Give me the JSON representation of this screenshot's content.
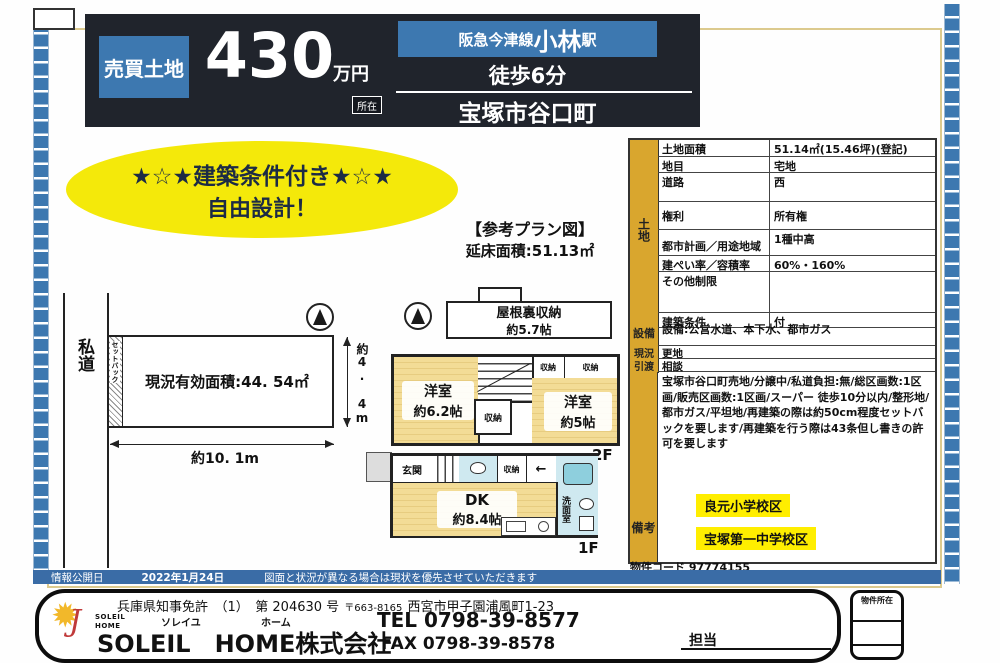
{
  "header": {
    "property_type": "売買土地",
    "price": "430",
    "price_unit": "万円",
    "rail_line": "阪急今津線 ",
    "station": "小林",
    "station_suffix": "駅",
    "walk": "徒歩6分",
    "location_tag": "所在",
    "address": "宝塚市谷口町"
  },
  "banner": {
    "line1": "★☆★建築条件付き★☆★",
    "line2": "自由設計！"
  },
  "plan": {
    "title": "【参考プラン図】",
    "total_floor_area": "延床面積:51.13㎡"
  },
  "site": {
    "road": "私道",
    "setback": "セットバック",
    "effective_area": "現況有効面積:44. 54㎡",
    "width": "約10. 1m",
    "depth": "約4. 4m"
  },
  "floor2": {
    "attic_line1": "屋根裏収納",
    "attic_line2": "約5.7帖",
    "room_left_line1": "洋室",
    "room_left_line2": "約6.2帖",
    "room_right_line1": "洋室",
    "room_right_line2": "約5帖",
    "closet": "収納",
    "label": "2F"
  },
  "floor1": {
    "entrance": "玄関",
    "closet": "収納",
    "dk_line1": "DK",
    "dk_line2": "約8.4帖",
    "washroom": "洗面室",
    "label": "1F"
  },
  "table": {
    "section_land": "土地",
    "rows": [
      {
        "label": "土地面積",
        "value": "51.14㎡(15.46坪)(登記)"
      },
      {
        "label": "地目",
        "value": "宅地"
      },
      {
        "label": "道路",
        "value": "西"
      },
      {
        "label": "権利",
        "value": "所有権"
      },
      {
        "label": "都市計画／用途地域",
        "value": "1種中高"
      },
      {
        "label": "建ぺい率／容積率",
        "value": "60%・160%"
      },
      {
        "label": "その他制限",
        "value": ""
      },
      {
        "label": "建築条件",
        "value": "付"
      }
    ],
    "section_setsubi": "設備",
    "setsubi_value": "設備:公営水道、本下水、都市ガス",
    "section_genkyo": "現況",
    "genkyo_value": "更地",
    "section_hikiwatashi": "引渡",
    "hikiwatashi_value": "相談",
    "section_biko": "備考",
    "biko_value": "宝塚市谷口町売地/分譲中/私道負担:無/総区画数:1区画/販売区画数:1区画/スーパー 徒歩10分以内/整形地/都市ガス/平坦地/再建築の際は約50cm程度セットバックを要します/再建築を行う際は43条但し書きの許可を要します",
    "school1": "良元小学校区",
    "school2": "宝塚第一中学校区"
  },
  "property_code": "物件コード 97774155",
  "info_bar": {
    "label": "情報公開日",
    "date": "2022年1月24日",
    "note": "図面と状況が異なる場合は現状を優先させていただきます"
  },
  "footer": {
    "license": "兵庫県知事免許　（1）　第 204630 号",
    "postal": "〒663-8165",
    "office_address": "西宮市甲子園浦風町1-23",
    "logo_text": "SOLEIL HOME",
    "furigana_soleil": "ソレイユ",
    "furigana_home": "ホーム",
    "company": "SOLEIL　HOME株式会社",
    "tel": "TEL 0798-39-8577",
    "fax": "FAX 0798-39-8578",
    "tanto": "担当",
    "stamp_label": "物件所在"
  },
  "icons": {
    "sun": "✹",
    "logo_j": "J",
    "left_arrow": "←"
  },
  "colors": {
    "header_bg": "#20242c",
    "accent_blue": "#3d78b0",
    "banner_yellow": "#f4e90a",
    "table_gold": "#d9a62e",
    "highlight_yellow": "#ffee00",
    "room_tan": "#f3dc96",
    "wet_blue": "#cfe9f0"
  }
}
